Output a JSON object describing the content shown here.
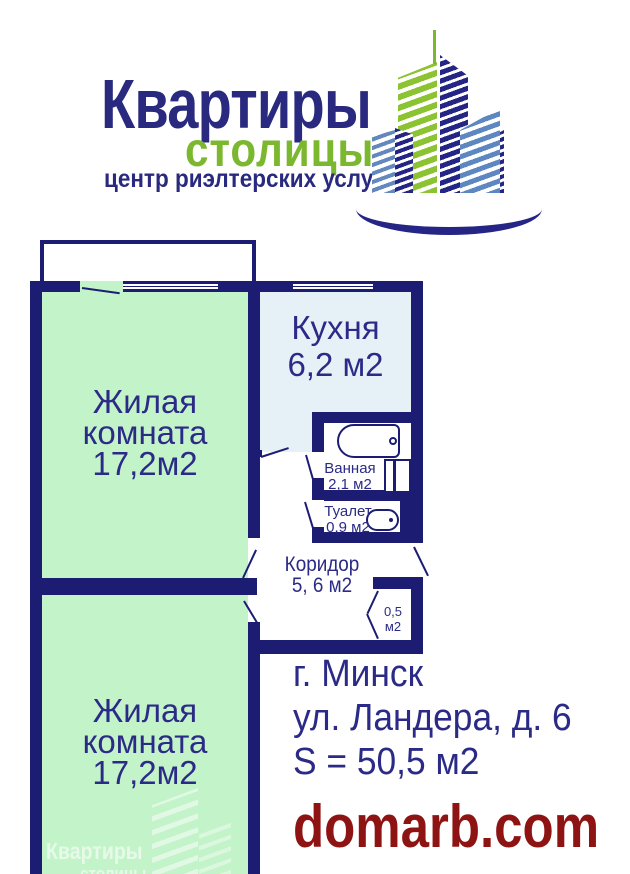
{
  "logo": {
    "title": "Квартиры",
    "subtitle": "столицы",
    "tagline": "центр риэлтерских услуг"
  },
  "plan": {
    "room1": {
      "line1": "Жилая",
      "line2": "комната",
      "line3": "17,2м2"
    },
    "room2": {
      "line1": "Жилая",
      "line2": "комната",
      "line3": "17,2м2"
    },
    "kitchen": {
      "line1": "Кухня",
      "line2": "6,2 м2"
    },
    "bath": {
      "line1": "Ванная",
      "line2": "2,1 м2"
    },
    "toilet": {
      "line1": "Туалет",
      "line2": "0,9 м2"
    },
    "corridor": {
      "line1": "Коридор",
      "line2": "5, 6 м2"
    },
    "closet": {
      "line1": "0,5",
      "line2": "м2"
    }
  },
  "address": {
    "city": "г. Минск",
    "street": "ул. Ландера, д. 6",
    "area": "S = 50,5 м2"
  },
  "footer": {
    "site": "domarb.com"
  },
  "watermark": {
    "line1": "Квартиры",
    "line2": "столицы"
  },
  "icons": {
    "bathtub-icon": "css-shape",
    "washing-machine-icon": "css-shape",
    "toilet-icon": "css-shape",
    "window-glyph": "css-shape",
    "door-leaf": "css-line",
    "buildings-logo-icon": "css-shape",
    "swoosh-icon": "css-arc"
  },
  "colors": {
    "wall_navy": "#1c1c72",
    "label_navy": "#2b2b87",
    "logo_navy": "#29297f",
    "room_green": "#c3f3c9",
    "kitchen_blue": "#e6f1f7",
    "logo_green": "#7cb82f",
    "building_blue": "#6288bd",
    "site_red": "#8e1414"
  }
}
